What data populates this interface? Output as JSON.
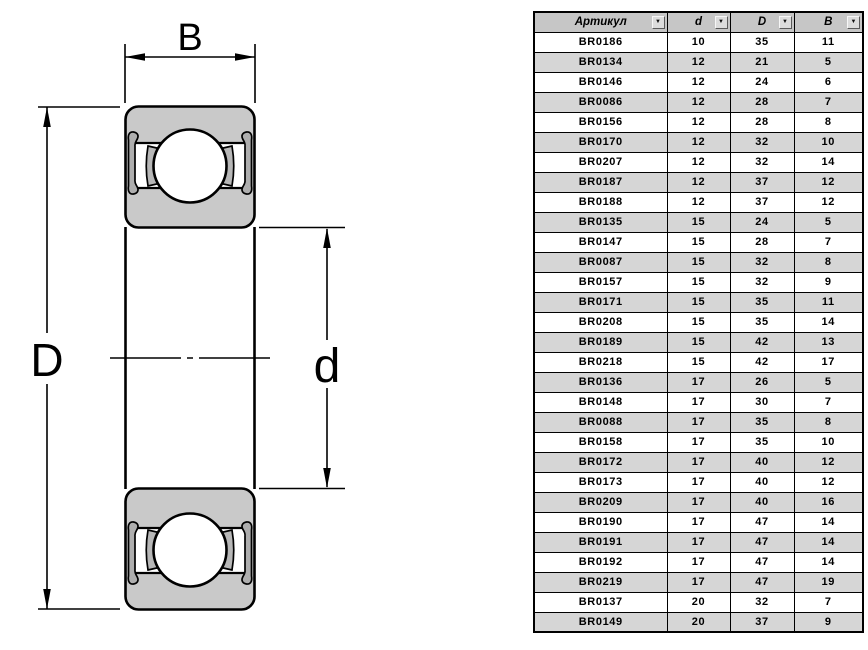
{
  "drawing": {
    "labels": {
      "width": "B",
      "outer_diameter": "D",
      "bore_diameter": "d"
    }
  },
  "table": {
    "columns": [
      {
        "key": "article",
        "label": "Артикул",
        "filter_icon": "▼"
      },
      {
        "key": "d",
        "label": "d",
        "filter_icon": "▼"
      },
      {
        "key": "D",
        "label": "D",
        "filter_icon": "▼"
      },
      {
        "key": "B",
        "label": "B",
        "filter_icon": "▼"
      }
    ],
    "rows": [
      {
        "article": "BR0186",
        "d": "10",
        "D": "35",
        "B": "11"
      },
      {
        "article": "BR0134",
        "d": "12",
        "D": "21",
        "B": "5"
      },
      {
        "article": "BR0146",
        "d": "12",
        "D": "24",
        "B": "6"
      },
      {
        "article": "BR0086",
        "d": "12",
        "D": "28",
        "B": "7"
      },
      {
        "article": "BR0156",
        "d": "12",
        "D": "28",
        "B": "8"
      },
      {
        "article": "BR0170",
        "d": "12",
        "D": "32",
        "B": "10"
      },
      {
        "article": "BR0207",
        "d": "12",
        "D": "32",
        "B": "14"
      },
      {
        "article": "BR0187",
        "d": "12",
        "D": "37",
        "B": "12"
      },
      {
        "article": "BR0188",
        "d": "12",
        "D": "37",
        "B": "12"
      },
      {
        "article": "BR0135",
        "d": "15",
        "D": "24",
        "B": "5"
      },
      {
        "article": "BR0147",
        "d": "15",
        "D": "28",
        "B": "7"
      },
      {
        "article": "BR0087",
        "d": "15",
        "D": "32",
        "B": "8"
      },
      {
        "article": "BR0157",
        "d": "15",
        "D": "32",
        "B": "9"
      },
      {
        "article": "BR0171",
        "d": "15",
        "D": "35",
        "B": "11"
      },
      {
        "article": "BR0208",
        "d": "15",
        "D": "35",
        "B": "14"
      },
      {
        "article": "BR0189",
        "d": "15",
        "D": "42",
        "B": "13"
      },
      {
        "article": "BR0218",
        "d": "15",
        "D": "42",
        "B": "17"
      },
      {
        "article": "BR0136",
        "d": "17",
        "D": "26",
        "B": "5"
      },
      {
        "article": "BR0148",
        "d": "17",
        "D": "30",
        "B": "7"
      },
      {
        "article": "BR0088",
        "d": "17",
        "D": "35",
        "B": "8"
      },
      {
        "article": "BR0158",
        "d": "17",
        "D": "35",
        "B": "10"
      },
      {
        "article": "BR0172",
        "d": "17",
        "D": "40",
        "B": "12"
      },
      {
        "article": "BR0173",
        "d": "17",
        "D": "40",
        "B": "12"
      },
      {
        "article": "BR0209",
        "d": "17",
        "D": "40",
        "B": "16"
      },
      {
        "article": "BR0190",
        "d": "17",
        "D": "47",
        "B": "14"
      },
      {
        "article": "BR0191",
        "d": "17",
        "D": "47",
        "B": "14"
      },
      {
        "article": "BR0192",
        "d": "17",
        "D": "47",
        "B": "14"
      },
      {
        "article": "BR0219",
        "d": "17",
        "D": "47",
        "B": "19"
      },
      {
        "article": "BR0137",
        "d": "20",
        "D": "32",
        "B": "7"
      },
      {
        "article": "BR0149",
        "d": "20",
        "D": "37",
        "B": "9"
      }
    ]
  },
  "colors": {
    "ring_fill": "#c9c9c9",
    "seal_fill": "#aeaeae",
    "line": "#000000",
    "header_bg": "#c6c6c6",
    "alt_row_bg": "#d6d6d6"
  }
}
